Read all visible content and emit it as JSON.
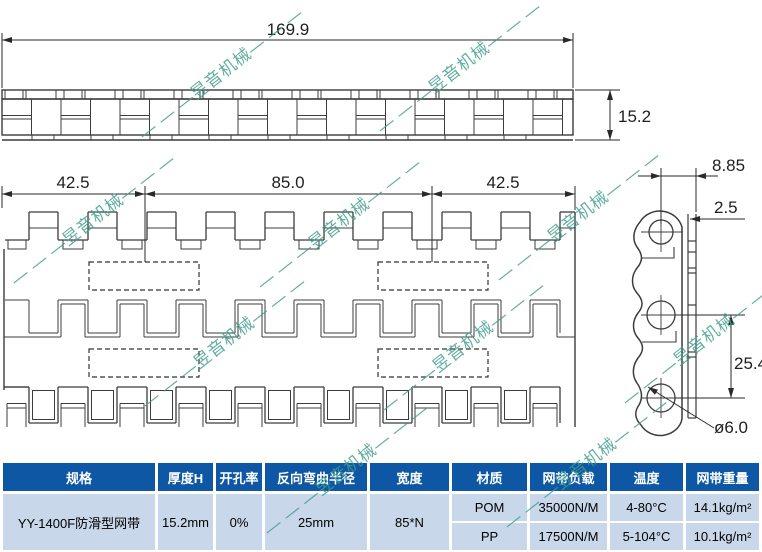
{
  "watermark": {
    "text": "— — —昱音机械— — —",
    "color": "#3F9C8C"
  },
  "drawing": {
    "dims": {
      "total_width": "169.9",
      "thickness": "15.2",
      "left_pitch": "42.5",
      "center_pitch": "85.0",
      "right_pitch": "42.5",
      "side_width": "8.85",
      "plate_thickness": "2.5",
      "hole_pitch": "25.4",
      "hole_diameter": "ø6.0"
    }
  },
  "table": {
    "colors": {
      "header_bg": "#0E57A5",
      "cell_bg": "#C9D7EA"
    },
    "headers": [
      "规格",
      "厚度H",
      "开孔率",
      "反向弯曲半径",
      "宽度",
      "材质",
      "网带负载",
      "温度",
      "网带重量"
    ],
    "spec": {
      "name": "YY-1400F防滑型网带",
      "thickness": "15.2mm",
      "open_rate": "0%",
      "bend_radius": "25mm",
      "width": "85*N"
    },
    "materials": [
      {
        "material": "POM",
        "load": "35000N/M",
        "temperature": "4-80°C",
        "weight": "14.1kg/m²"
      },
      {
        "material": "PP",
        "load": "17500N/M",
        "temperature": "5-104°C",
        "weight": "10.1kg/m²"
      }
    ]
  }
}
